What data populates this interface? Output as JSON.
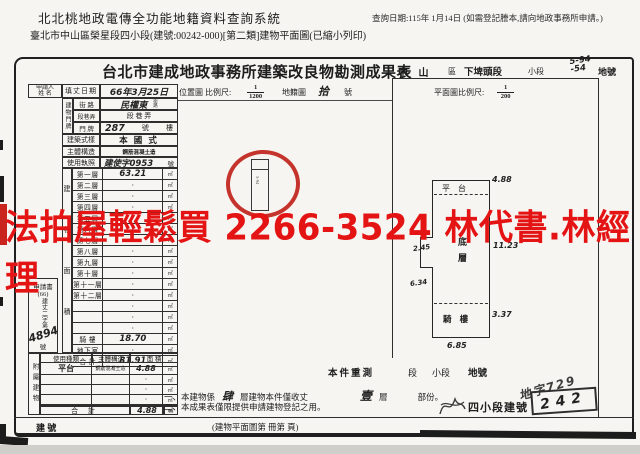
{
  "header": {
    "system_title": "北北桃地政電傳全功能地籍資料查詢系統",
    "query_date": "查詢日期:115年 1月14日 (如需登記謄本,請向地政事務所申請。)",
    "doc_line": "臺北市中山區榮星段四小段(建號:00242-000)[第二類]建物平面圖(已縮小列印)"
  },
  "watermark": {
    "text": "法拍屋輕鬆買 2266-3524 林代書.林經理",
    "color": "#e41414"
  },
  "form": {
    "title": "台北市建成地政事務所建築改良物勘測成果表",
    "district": {
      "city_area": "中  山",
      "area_suffix": "區",
      "section": "下埤頭段",
      "subsection_label": "小段",
      "land_no_line1": "5-94",
      "land_no_line2": "-54",
      "land_no_suffix": "地號"
    },
    "applicant": {
      "label_1": "申請人",
      "label_2": "姓  名",
      "date_label": "填丈日期",
      "date_value": "66年3月25日"
    },
    "address": {
      "group": "建物門牌",
      "street_label": "街 路",
      "street_value": "民權東",
      "street_tiny_1": "街",
      "street_tiny_2": "路",
      "lane_label": "段巷弄",
      "lane_value": "段   巷   弄",
      "door_label": "門 牌",
      "door_value": "287",
      "door_suffix": "號",
      "floor_suffix": "樓"
    },
    "style": {
      "label": "建築式樣",
      "value": "本 國 式"
    },
    "structure": {
      "label": "主體構造",
      "value": "鋼筋混凝土造"
    },
    "license": {
      "label": "使用執照",
      "value": "建使字0953",
      "suffix": "號"
    },
    "area_table": {
      "strip": "建物面積",
      "unit": "㎡",
      "rows": [
        {
          "label": "第一層",
          "value": "63.21",
          "hand": true
        },
        {
          "label": "第二層",
          "value": "·"
        },
        {
          "label": "第三層",
          "value": "·"
        },
        {
          "label": "第四層",
          "value": "·"
        },
        {
          "label": "第五層",
          "value": "·"
        },
        {
          "label": "第六層",
          "value": "·"
        },
        {
          "label": "第七層",
          "value": "·"
        },
        {
          "label": "第八層",
          "value": "·"
        },
        {
          "label": "第九層",
          "value": "·"
        },
        {
          "label": "第十層",
          "value": "·"
        },
        {
          "label": "第十一層",
          "value": "·"
        },
        {
          "label": "第十二層",
          "value": "·"
        },
        {
          "label": "",
          "value": "·"
        },
        {
          "label": "",
          "value": "·"
        },
        {
          "label": "",
          "value": "·"
        },
        {
          "label": "騎 樓",
          "value": "18.70",
          "hand": true
        },
        {
          "label": "地下室",
          "value": "·"
        },
        {
          "label": "合 計",
          "value": "81.91",
          "hand": true
        }
      ]
    },
    "application": {
      "title": "申請書",
      "line_1": "(66)",
      "chars": "建丈二字第",
      "number": "4894",
      "suffix": "號"
    },
    "annex": {
      "strip": "附屬建物",
      "headers": {
        "h1": "使用種類",
        "h2": "主體構造",
        "h3": "面    積"
      },
      "unit": "㎡",
      "rows": [
        {
          "type": "平台",
          "structure": "鋼筋混凝土造",
          "area": "4.88",
          "hand": true
        },
        {
          "type": "",
          "structure": "",
          "area": "·"
        },
        {
          "type": "",
          "structure": "",
          "area": "·"
        },
        {
          "type": "",
          "structure": "",
          "area": "·"
        },
        {
          "type": "",
          "structure": "",
          "area": "·"
        }
      ],
      "total_label": "合  計",
      "total_value": "4.88"
    },
    "location": {
      "label": "位置圖  比例尺:",
      "scale_num": "1",
      "scale_den": "1200",
      "map_label": "地籍圖",
      "map_no": "拾",
      "map_no_suffix": "號",
      "sketch_note": "5-94"
    },
    "plan": {
      "scale_label": "平面圖比例尺:",
      "scale_num": "1",
      "scale_den": "200",
      "labels": {
        "platform": "平  台",
        "ground_1": "底",
        "ground_2": "層",
        "arcade": "騎 樓"
      },
      "dims": {
        "top": "4.88",
        "notch": "2.45",
        "right": "11.23",
        "left": "6.34",
        "arcade_right": "3.37",
        "bottom": "6.85"
      }
    },
    "resurvey": {
      "label": "本件重測",
      "sec": "段",
      "subsec": "小段",
      "landno": "地號"
    },
    "notes": {
      "n1_pre": "一、本建物係",
      "n1_hand1": "肆",
      "n1_mid": "層建物本件僅收丈",
      "n1_hand2": "壹",
      "n1_post": "層",
      "n1_end": "部份。",
      "n2": "二、本成果表僅限提供申請建物登記之用。"
    },
    "stamps": {
      "note": "地字729",
      "stamp_label": "四小段建號",
      "stamp_value": "242"
    },
    "bottom": {
      "building_no": "建      號",
      "book_ref": "(建物平面圖第     冊第     頁)"
    }
  }
}
